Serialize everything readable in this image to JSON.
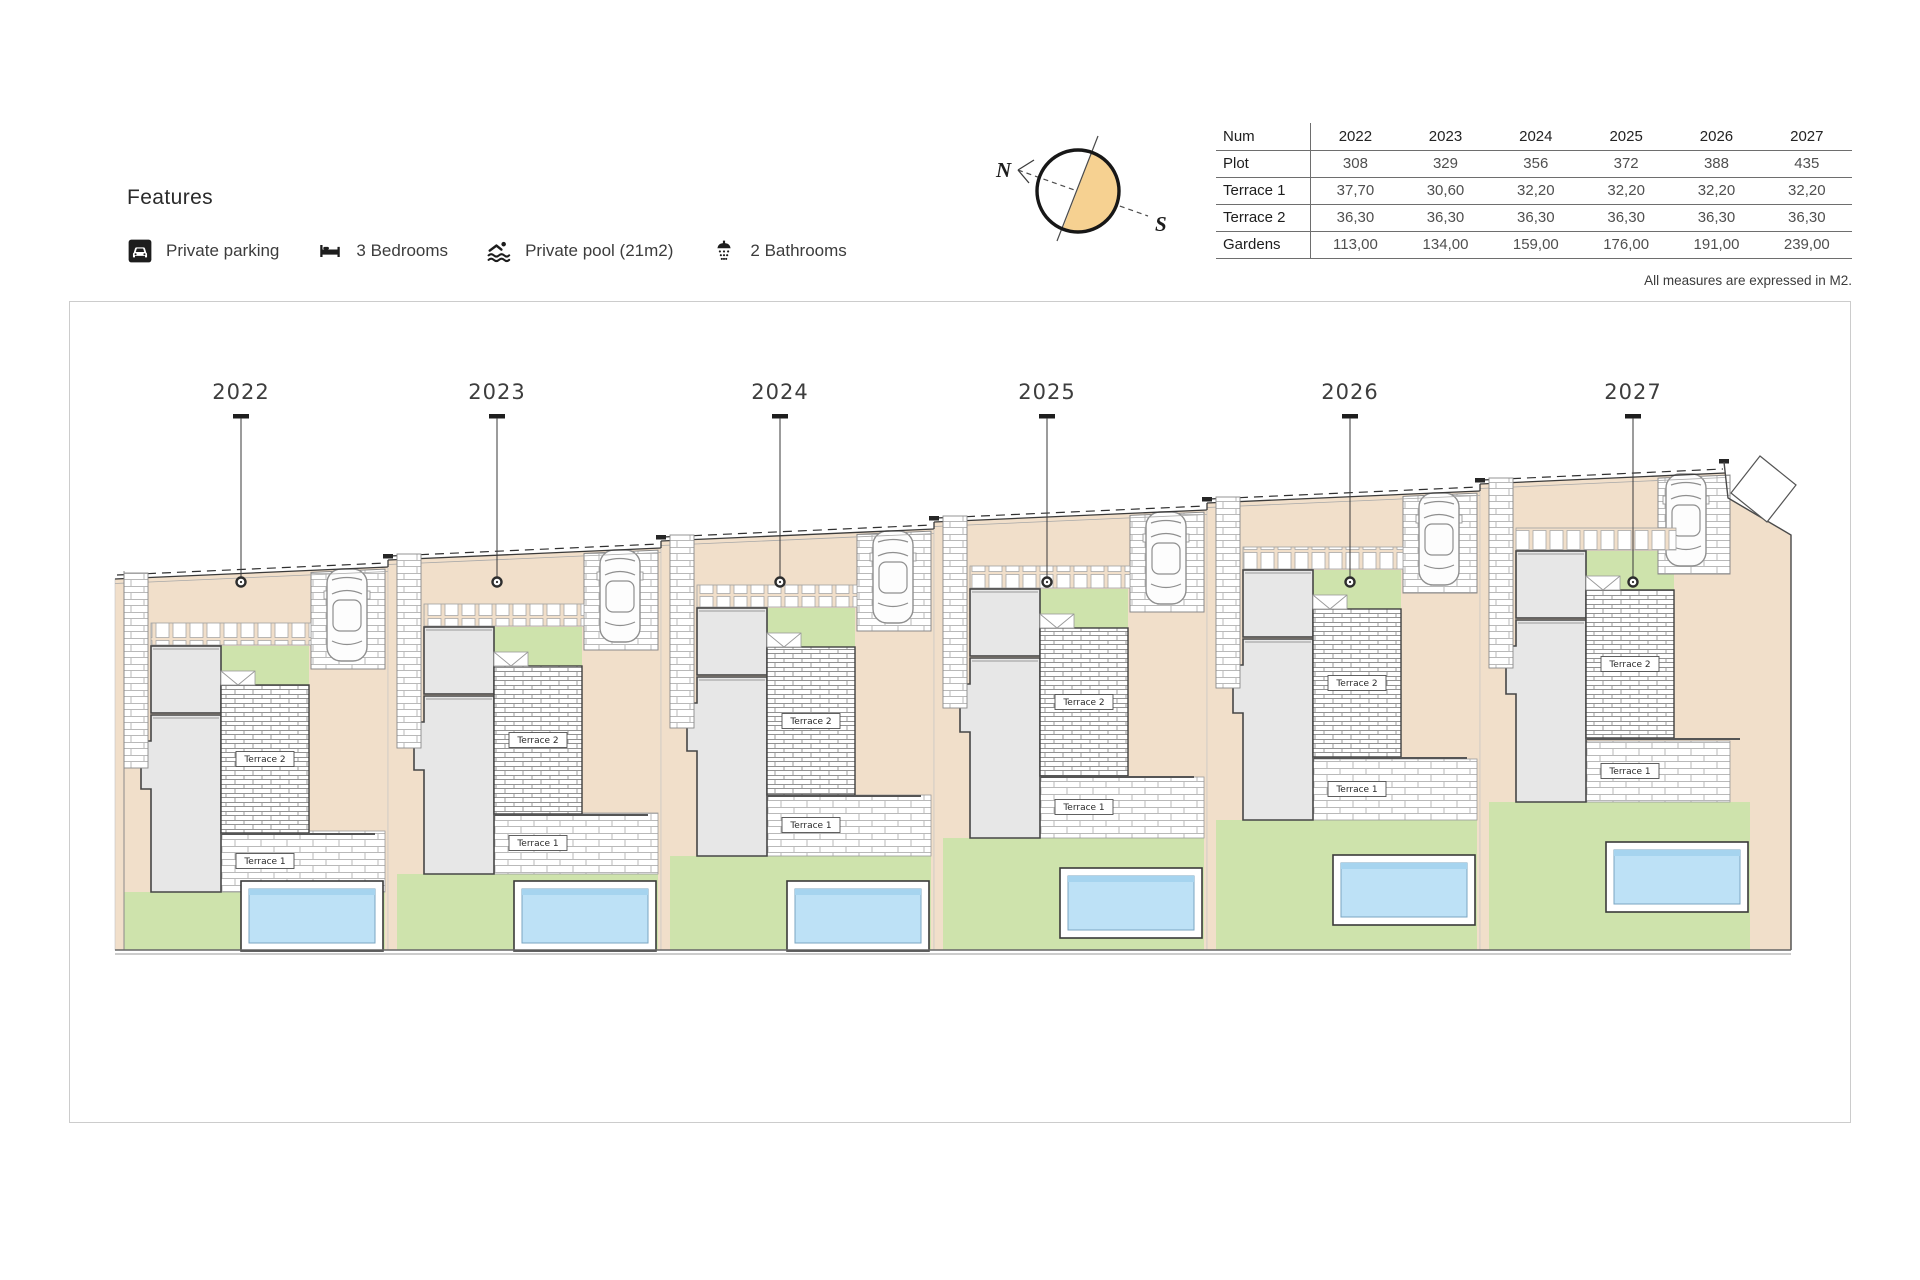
{
  "features": {
    "title": "Features",
    "items": [
      {
        "icon": "parking-icon",
        "label": "Private parking"
      },
      {
        "icon": "bed-icon",
        "label": "3 Bedrooms"
      },
      {
        "icon": "pool-icon",
        "label": "Private pool (21m2)"
      },
      {
        "icon": "shower-icon",
        "label": "2 Bathrooms"
      }
    ]
  },
  "compass": {
    "north_label": "N",
    "south_label": "S",
    "accent_color": "#f6d191"
  },
  "table": {
    "header": [
      "Num",
      "2022",
      "2023",
      "2024",
      "2025",
      "2026",
      "2027"
    ],
    "rows": [
      {
        "label": "Plot",
        "values": [
          "308",
          "329",
          "356",
          "372",
          "388",
          "435"
        ]
      },
      {
        "label": "Terrace 1",
        "values": [
          "37,70",
          "30,60",
          "32,20",
          "32,20",
          "32,20",
          "32,20"
        ]
      },
      {
        "label": "Terrace 2",
        "values": [
          "36,30",
          "36,30",
          "36,30",
          "36,30",
          "36,30",
          "36,30"
        ]
      },
      {
        "label": "Gardens",
        "values": [
          "113,00",
          "134,00",
          "159,00",
          "176,00",
          "191,00",
          "239,00"
        ]
      }
    ],
    "note": "All measures are expressed in M2."
  },
  "plan": {
    "plot_labels": [
      "2022",
      "2023",
      "2024",
      "2025",
      "2026",
      "2027"
    ],
    "terrace1_label": "Terrace 1",
    "terrace2_label": "Terrace 2",
    "colors": {
      "beige": "#f1dfca",
      "green": "#cee3ac",
      "pool_water": "#bde1f6",
      "pool_water_dark": "#a6d4ef",
      "house_fill": "#e7e7e7",
      "brick_line": "#b9b9b9",
      "brick_dark_line": "#929292"
    }
  }
}
